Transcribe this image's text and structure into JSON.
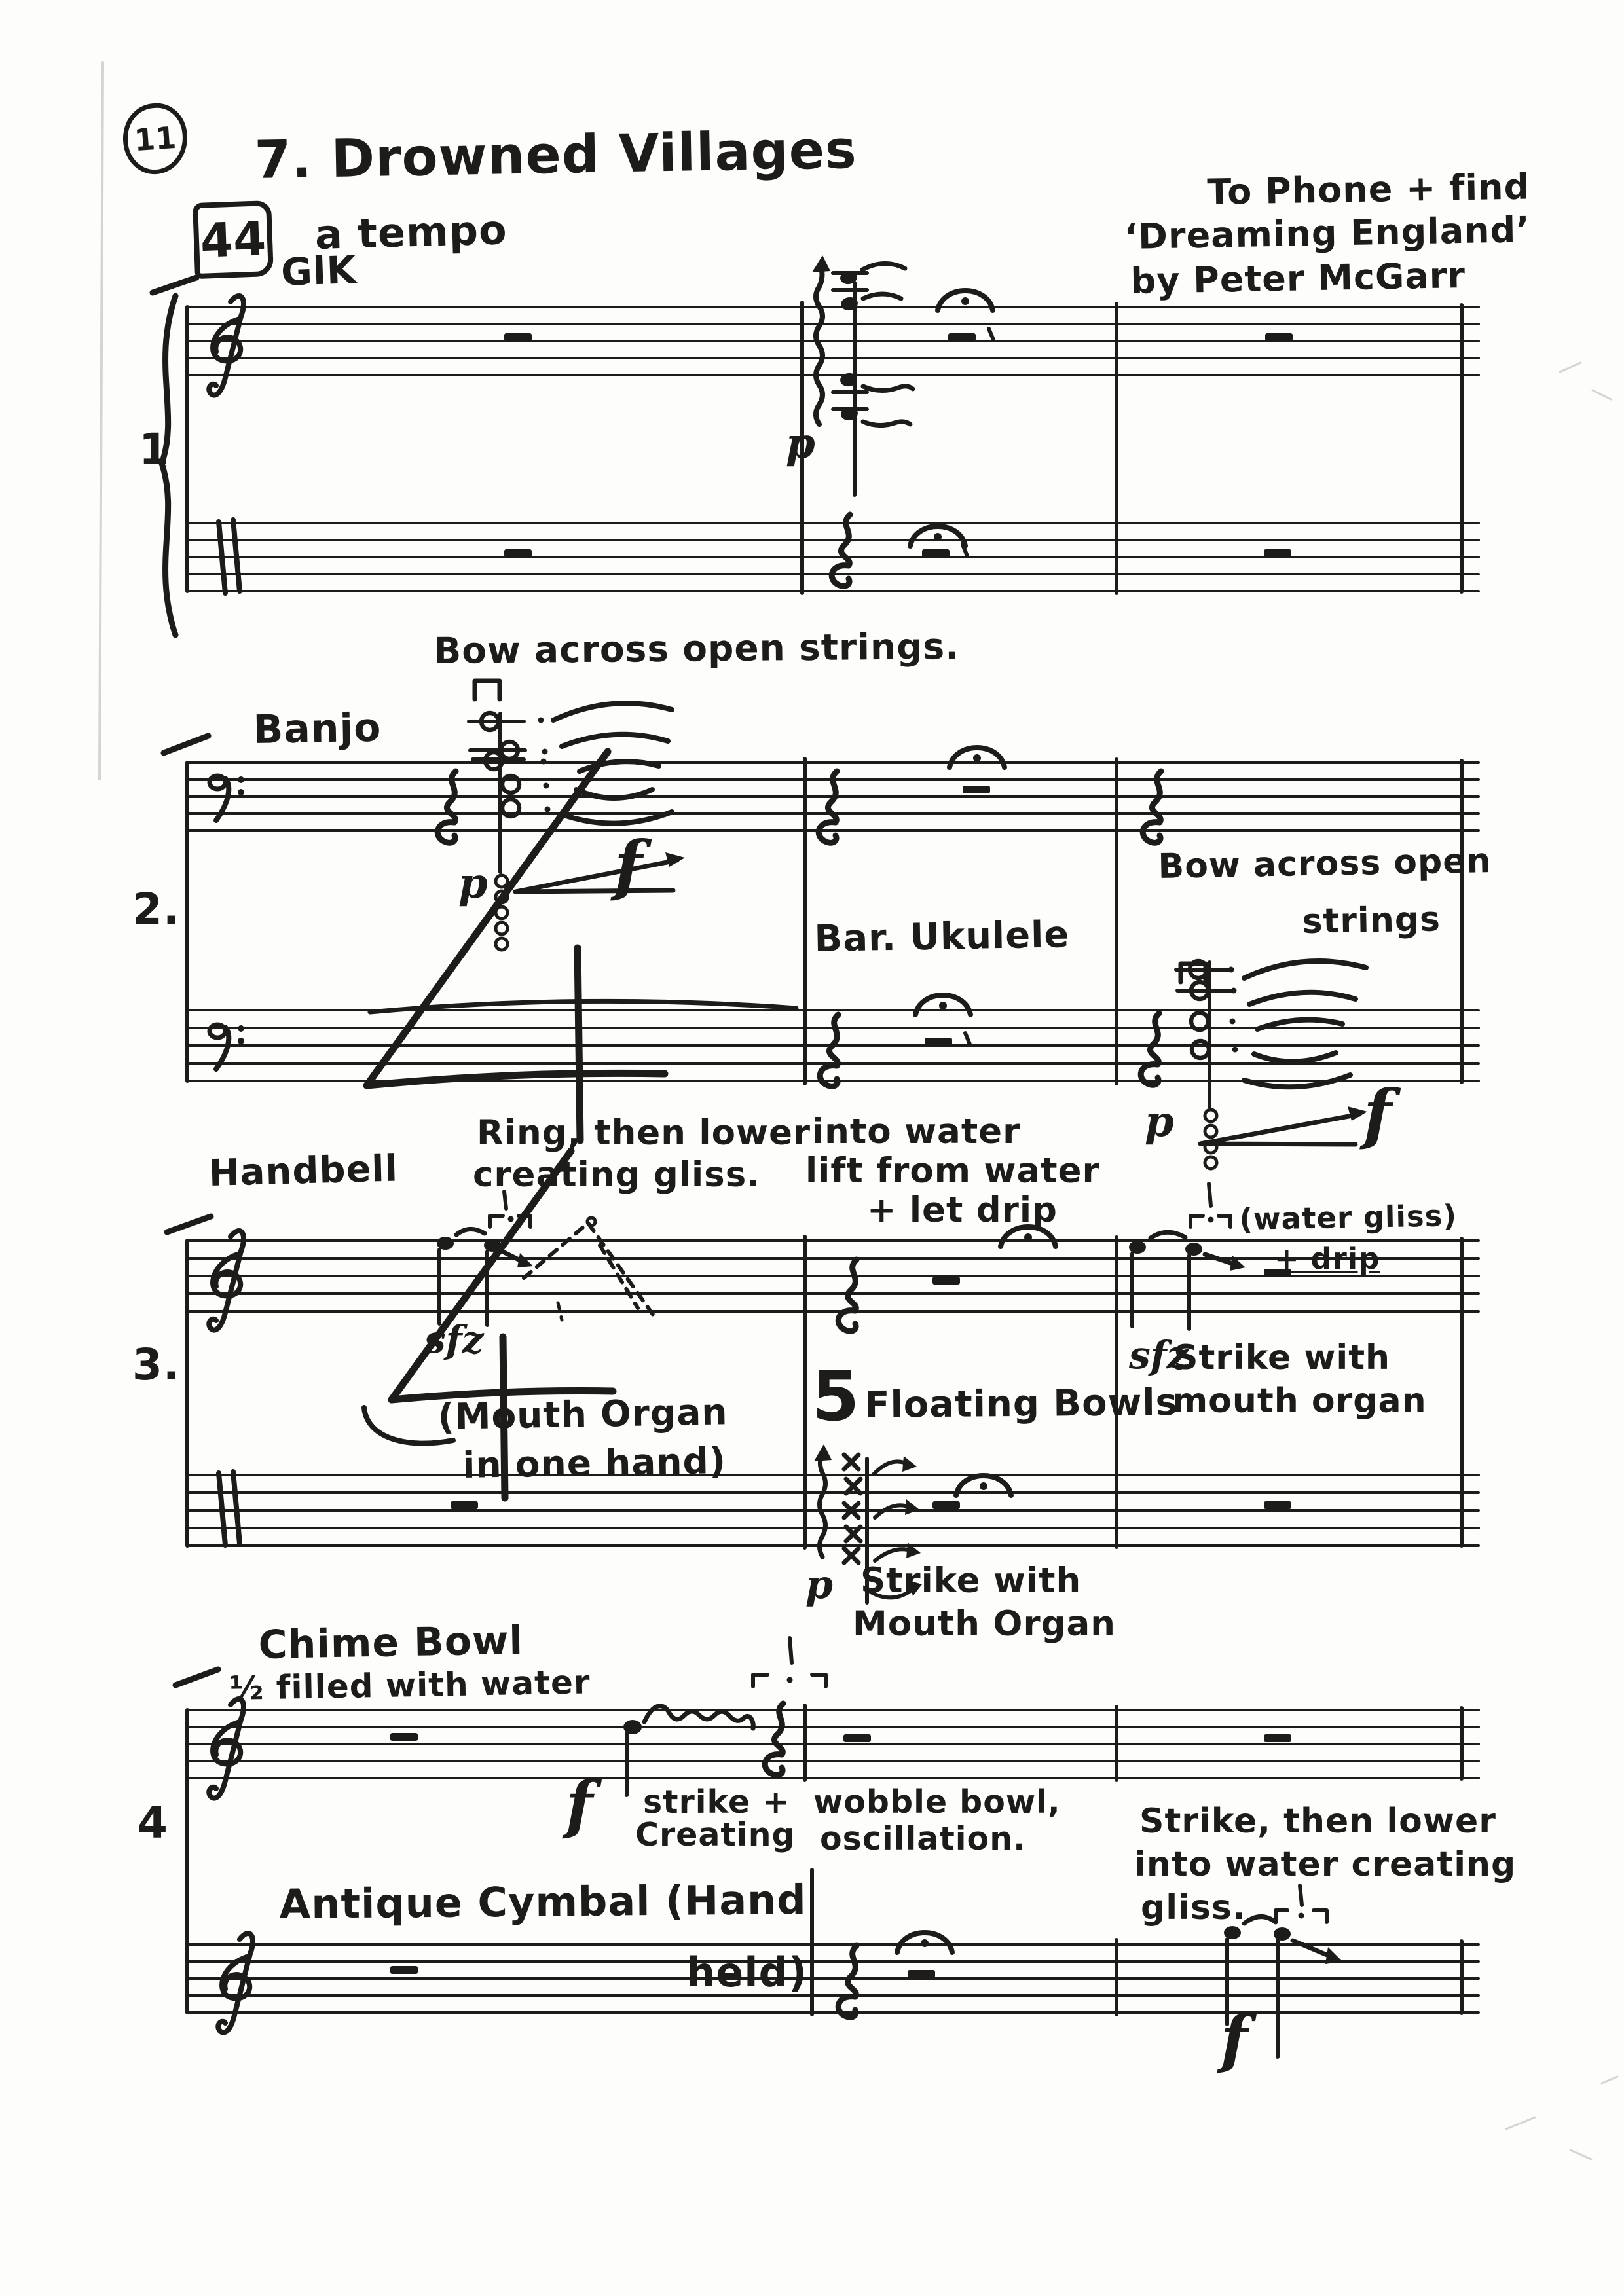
{
  "page": {
    "number": "11",
    "title": "7. Drowned Villages",
    "rehearsal": "44",
    "tempo": "a tempo",
    "dedication_line1": "To Phone + find",
    "dedication_line2": "‘Dreaming England’",
    "dedication_line3": "by Peter McGarr"
  },
  "system1": {
    "number": "1",
    "instrument": "GlK",
    "dyn_p": "p"
  },
  "system2": {
    "number": "2.",
    "banjo": "Banjo",
    "ukulele": "Bar. Ukulele",
    "bow_m1": "Bow across open strings.",
    "bow_m3_line1": "Bow across open",
    "bow_m3_line2": "strings",
    "p1": "p",
    "f1": "f",
    "p2": "p",
    "f2": "f"
  },
  "system3": {
    "number": "3.",
    "handbell": "Handbell",
    "ring_line1": "Ring, then lower",
    "ring_line2": "creating gliss.",
    "water_line1": "into water",
    "water_line2": "lift from water",
    "water_line3": "+ let drip",
    "sfz1": "sfz",
    "watergliss": "(water gliss)",
    "drip": "+ drip",
    "sfz2": "sfz",
    "strike_line1": "Strike with",
    "strike_line2": "mouth organ",
    "mouthorgan_line1": "(Mouth Organ",
    "mouthorgan_line2": "in one hand)",
    "five": "5",
    "bowls": "Floating Bowls",
    "p": "p",
    "strike2_line1": "Strike with",
    "strike2_line2": "Mouth Organ"
  },
  "system4": {
    "number": "4",
    "chime_line1": "Chime Bowl",
    "chime_line2": "½ filled with water",
    "f1": "f",
    "strike_line1": "strike +",
    "strike_line2": "Creating",
    "wobble_line1": "wobble bowl,",
    "wobble_line2": "oscillation.",
    "cymbal_line1": "Antique Cymbal (Hand",
    "cymbal_line2": "held)",
    "lower_line1": "Strike, then lower",
    "lower_line2": "into water creating",
    "lower_line3": "gliss.",
    "f2": "f"
  }
}
